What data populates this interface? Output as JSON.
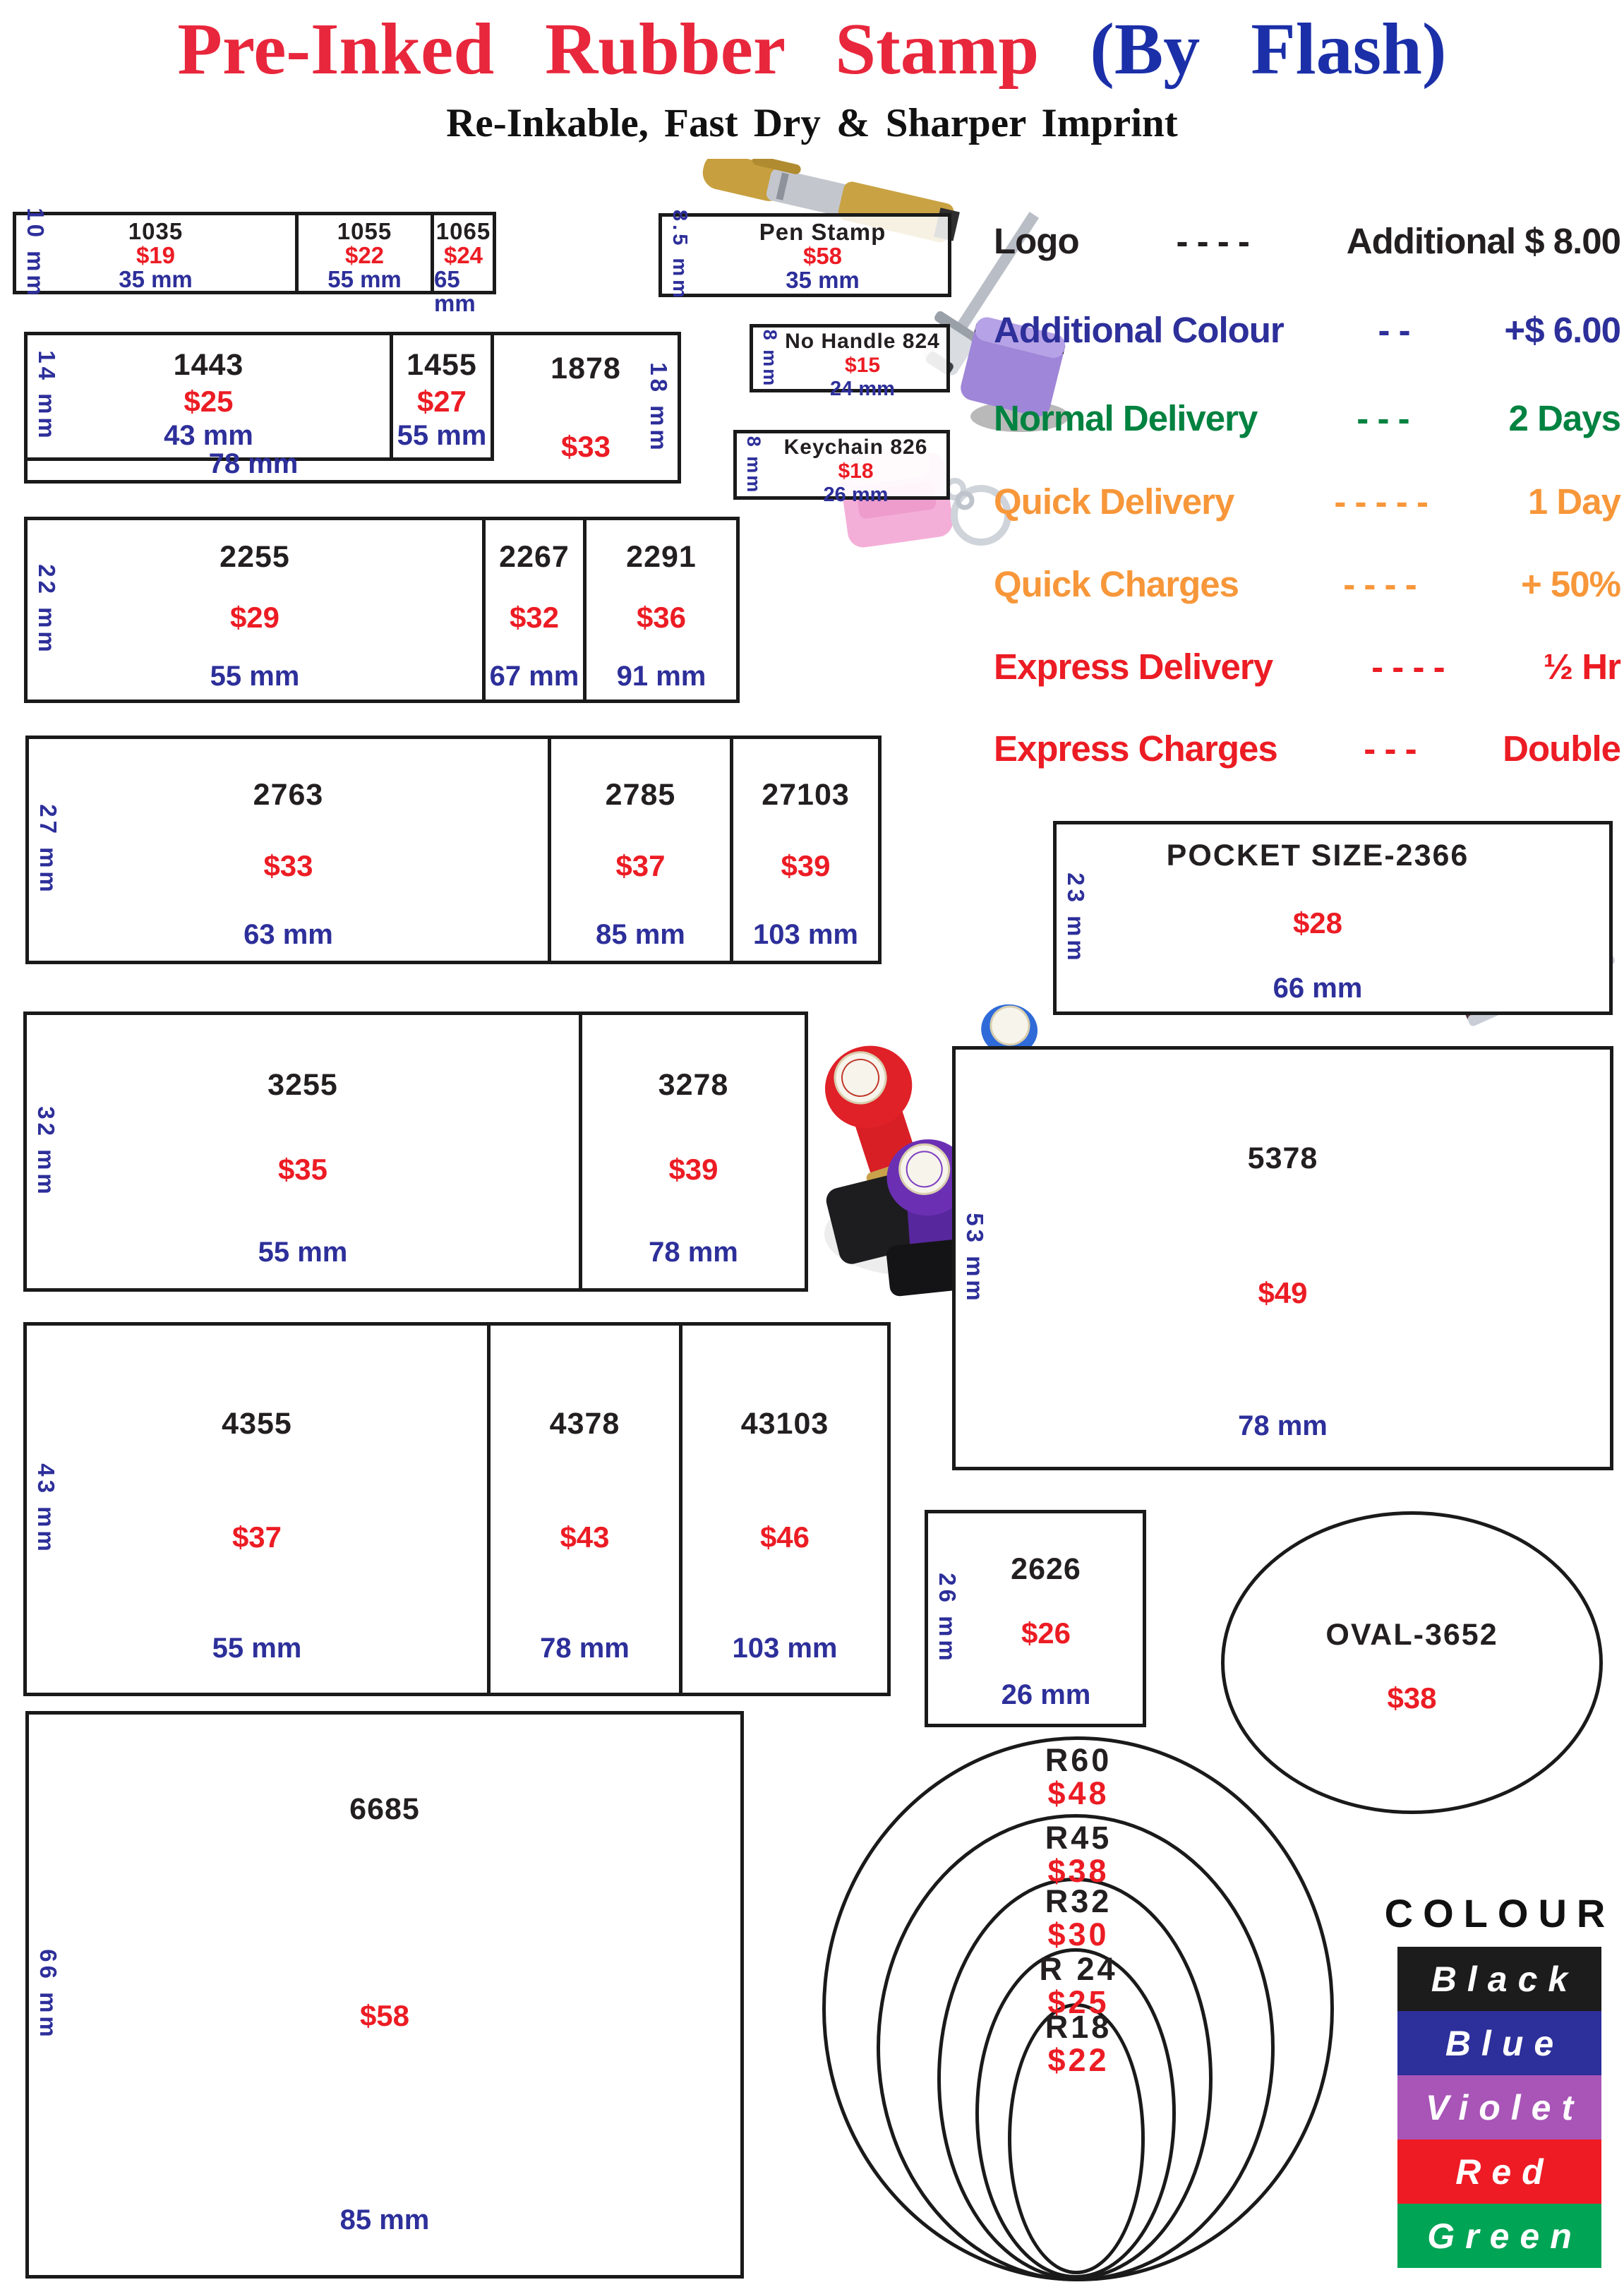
{
  "header": {
    "title_red": "Pre-Inked  Rubber  Stamp ",
    "title_blue": "(By Flash)",
    "subtitle": "Re-Inkable, Fast Dry & Sharper Imprint"
  },
  "info_lines": [
    {
      "label": "Logo",
      "dashes": "- - - -",
      "value": "Additional  $ 8.00",
      "color": "#231f20"
    },
    {
      "label": "Additional  Colour",
      "dashes": "- -",
      "value": "+$ 6.00",
      "color": "#2d2f9a"
    },
    {
      "label": "Normal  Delivery",
      "dashes": "- - -",
      "value": "2 Days",
      "color": "#008240"
    },
    {
      "label": "Quick  Delivery",
      "dashes": "- - - - -",
      "value": "1 Day",
      "color": "#f7973a"
    },
    {
      "label": "Quick  Charges",
      "dashes": "- - - -",
      "value": "+ 50%",
      "color": "#f7973a"
    },
    {
      "label": "Express Delivery",
      "dashes": "- - - -",
      "value": "½ Hr",
      "color": "#ec1c24"
    },
    {
      "label": "Express Charges",
      "dashes": "- - -",
      "value": "Double",
      "color": "#ec1c24"
    }
  ],
  "groups": {
    "row1": {
      "height_label": "10 mm",
      "cells": [
        {
          "model": "1035",
          "price": "$19",
          "size": "35 mm"
        },
        {
          "model": "1055",
          "price": "$22",
          "size": "55 mm"
        },
        {
          "model": "1065",
          "price": "$24",
          "size": "65 mm"
        }
      ]
    },
    "pen": {
      "height_label": "8.5 mm",
      "model": "Pen Stamp",
      "price": "$58",
      "size": "35 mm"
    },
    "row2": {
      "height_label": "14 mm",
      "bottom_size": "78 mm",
      "cells": [
        {
          "model": "1443",
          "price": "$25",
          "size": "43 mm"
        },
        {
          "model": "1455",
          "price": "$27",
          "size": "55 mm"
        }
      ],
      "side": {
        "model": "1878",
        "price": "$33",
        "height_label": "18 mm"
      }
    },
    "no_handle": {
      "height_label": "8 mm",
      "model": "No Handle 824",
      "price": "$15",
      "size": "24 mm"
    },
    "keychain": {
      "height_label": "8 mm",
      "model": "Keychain 826",
      "price": "$18",
      "size": "26 mm"
    },
    "row3": {
      "height_label": "22 mm",
      "cells": [
        {
          "model": "2255",
          "price": "$29",
          "size": "55 mm"
        },
        {
          "model": "2267",
          "price": "$32",
          "size": "67 mm"
        },
        {
          "model": "2291",
          "price": "$36",
          "size": "91 mm"
        }
      ]
    },
    "row4": {
      "height_label": "27 mm",
      "cells": [
        {
          "model": "2763",
          "price": "$33",
          "size": "63 mm"
        },
        {
          "model": "2785",
          "price": "$37",
          "size": "85 mm"
        },
        {
          "model": "27103",
          "price": "$39",
          "size": "103 mm"
        }
      ]
    },
    "pocket": {
      "height_label": "23 mm",
      "title": "POCKET SIZE-2366",
      "price": "$28",
      "size": "66 mm"
    },
    "row5": {
      "height_label": "32 mm",
      "cells": [
        {
          "model": "3255",
          "price": "$35",
          "size": "55 mm"
        },
        {
          "model": "3278",
          "price": "$39",
          "size": "78 mm"
        }
      ]
    },
    "box5378": {
      "height_label": "53 mm",
      "model": "5378",
      "price": "$49",
      "size": "78 mm"
    },
    "row6": {
      "height_label": "43 mm",
      "cells": [
        {
          "model": "4355",
          "price": "$37",
          "size": "55 mm"
        },
        {
          "model": "4378",
          "price": "$43",
          "size": "78 mm"
        },
        {
          "model": "43103",
          "price": "$46",
          "size": "103 mm"
        }
      ]
    },
    "box2626": {
      "height_label": "26 mm",
      "model": "2626",
      "price": "$26",
      "size": "26 mm"
    },
    "oval": {
      "title": "OVAL-3652",
      "price": "$38"
    },
    "box6685": {
      "height_label": "66 mm",
      "model": "6685",
      "price": "$58",
      "size": "85 mm"
    },
    "circles": [
      {
        "name": "R60",
        "price": "$48"
      },
      {
        "name": "R45",
        "price": "$38"
      },
      {
        "name": "R32",
        "price": "$30"
      },
      {
        "name": "R 24",
        "price": "$25"
      },
      {
        "name": "R18",
        "price": "$22"
      }
    ]
  },
  "colour_legend": {
    "title": "COLOUR",
    "entries": [
      {
        "name": "Black",
        "hex": "#1c1c1c"
      },
      {
        "name": "Blue",
        "hex": "#2d2f9a"
      },
      {
        "name": "Violet",
        "hex": "#a855b7"
      },
      {
        "name": "Red",
        "hex": "#ee1b24"
      },
      {
        "name": "Green",
        "hex": "#00a455"
      }
    ]
  },
  "palette": {
    "price_red": "#ec1c24",
    "dimension_blue": "#2d2f9a",
    "model_black": "#231f20",
    "title_red": "#e8273c",
    "title_blue": "#1b2fa8"
  }
}
